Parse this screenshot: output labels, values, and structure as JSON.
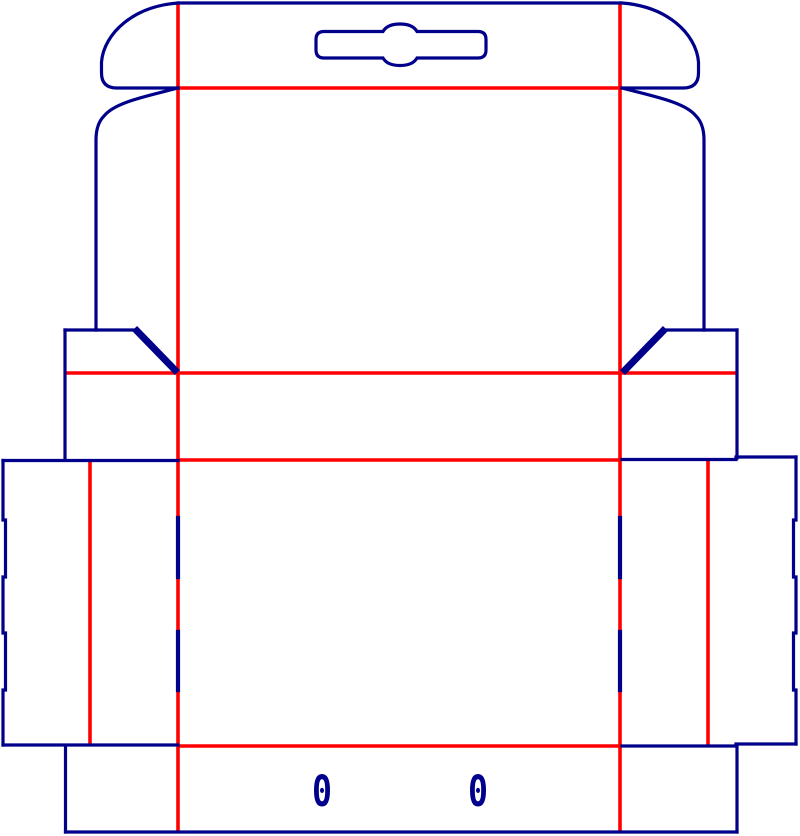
{
  "diagram": {
    "kind": "packaging-box-dieline",
    "canvas": {
      "width": 800,
      "height": 836,
      "background": "#FFFFFF"
    },
    "palette": {
      "cut_line": "#00008B",
      "crease_line": "#FF0000"
    },
    "stroke_widths": {
      "cut": 3.2,
      "crease": 3.6,
      "heavy_cut": 7,
      "slit": 4.2
    },
    "labels": [
      {
        "name": "zero-mark-left",
        "text": "0",
        "x": 322,
        "y": 806
      },
      {
        "name": "zero-mark-right",
        "text": "0",
        "x": 478,
        "y": 806
      }
    ],
    "paths": [
      {
        "name": "crease-vertical-left",
        "type": "crease",
        "d": "M 178 3 L 178 832"
      },
      {
        "name": "crease-vertical-right",
        "type": "crease",
        "d": "M 620 3 L 620 832"
      },
      {
        "name": "crease-hang-tab-fold",
        "type": "crease",
        "d": "M 178 88 L 620 88"
      },
      {
        "name": "crease-waist-fold",
        "type": "crease",
        "d": "M 65 373 L 737 373"
      },
      {
        "name": "crease-front-top-fold",
        "type": "crease",
        "d": "M 178 460 L 620 460"
      },
      {
        "name": "crease-front-bottom-fold",
        "type": "crease",
        "d": "M 178 746 L 620 746"
      },
      {
        "name": "crease-left-column",
        "type": "crease",
        "d": "M 90 461 L 90 745"
      },
      {
        "name": "crease-right-column",
        "type": "crease",
        "d": "M 708 461 L 708 745"
      },
      {
        "name": "cut-top-edge",
        "type": "cut",
        "d": "M 178 3 L 620 3"
      },
      {
        "name": "cut-hang-tab-left",
        "type": "cut",
        "d": "M 178 3 C 134 6 104 33 101.5 62 L 101.5 73 Q 101.5 88 117 88 L 178 88"
      },
      {
        "name": "cut-hang-tab-right",
        "type": "cut",
        "d": "M 622 3 C 666 6 696 33 698.5 62 L 698.5 73 Q 698.5 88 683 88 L 622 88"
      },
      {
        "name": "cut-euro-hang-slot",
        "type": "cut",
        "d": "M 324 31.5 L 383 31.5 C 387 24.5 395 24 400 24 C 405 24 413 24.5 417 31.5 L 478 31.5 Q 486 31.5 486 39.5 L 486 50 Q 486 58 478 58 L 417 58 C 413 65 405 65.5 400 65.5 C 395 65.5 387 65 383 58 L 324 58 Q 316 58 316 50 L 316 39.5 Q 316 31.5 324 31.5 Z"
      },
      {
        "name": "cut-back-left-edge",
        "type": "cut",
        "d": "M 178 88 C 148 96 115 102 104 116 Q 96 124 96 140 L 96 330"
      },
      {
        "name": "cut-back-right-edge",
        "type": "cut",
        "d": "M 622 88 C 652 96 685 102 696 116 Q 704 124 704 140 L 704 330"
      },
      {
        "name": "cut-left-ear-top",
        "type": "cut",
        "d": "M 65 330 L 136 330"
      },
      {
        "name": "cut-right-ear-top",
        "type": "cut",
        "d": "M 664 330 L 737 330"
      },
      {
        "name": "cut-left-ear-diagonal",
        "type": "heavy",
        "d": "M 137 331 L 175 370"
      },
      {
        "name": "cut-right-ear-diagonal",
        "type": "heavy",
        "d": "M 663 331 L 625 370"
      },
      {
        "name": "cut-left-band-edge",
        "type": "cut",
        "d": "M 65 330 L 65 460"
      },
      {
        "name": "cut-right-band-edge",
        "type": "cut",
        "d": "M 737 330 L 737 458"
      },
      {
        "name": "cut-left-column-top",
        "type": "cut",
        "d": "M 3 460.5 L 178 460.5"
      },
      {
        "name": "cut-right-column-top",
        "type": "cut",
        "d": "M 622 459.5 L 736 459.5 L 736 457 L 796 457"
      },
      {
        "name": "cut-left-outer-edge",
        "type": "cut",
        "d": "M 3 460.5 L 3 520 L 5.5 520 L 5.5 577 L 3 577 L 3 633 L 5.5 633 L 5.5 690 L 3 690 L 3 745"
      },
      {
        "name": "cut-right-outer-edge",
        "type": "cut",
        "d": "M 796 457 L 796 520 L 793.5 520 L 793.5 577 L 796 577 L 796 633 L 793.5 633 L 793.5 690 L 796 690 L 796 744"
      },
      {
        "name": "cut-left-column-bottom",
        "type": "cut",
        "d": "M 3 745 L 178 745"
      },
      {
        "name": "cut-right-column-bottom",
        "type": "cut",
        "d": "M 622 746 L 736 746 L 736 744 L 796 744"
      },
      {
        "name": "cut-bottom-flap-left-edge",
        "type": "cut",
        "d": "M 65.5 746 L 65.5 832"
      },
      {
        "name": "cut-bottom-flap-right-edge",
        "type": "cut",
        "d": "M 737 746 L 737 832"
      },
      {
        "name": "cut-bottom-edge",
        "type": "cut",
        "d": "M 65.5 832 L 737 832"
      },
      {
        "name": "slit-left-upper",
        "type": "slit",
        "d": "M 178 518 L 178 577"
      },
      {
        "name": "slit-left-lower",
        "type": "slit",
        "d": "M 178 632 L 178 690"
      },
      {
        "name": "slit-right-upper",
        "type": "slit",
        "d": "M 620 518 L 620 577"
      },
      {
        "name": "slit-right-lower",
        "type": "slit",
        "d": "M 620 632 L 620 690"
      }
    ]
  }
}
